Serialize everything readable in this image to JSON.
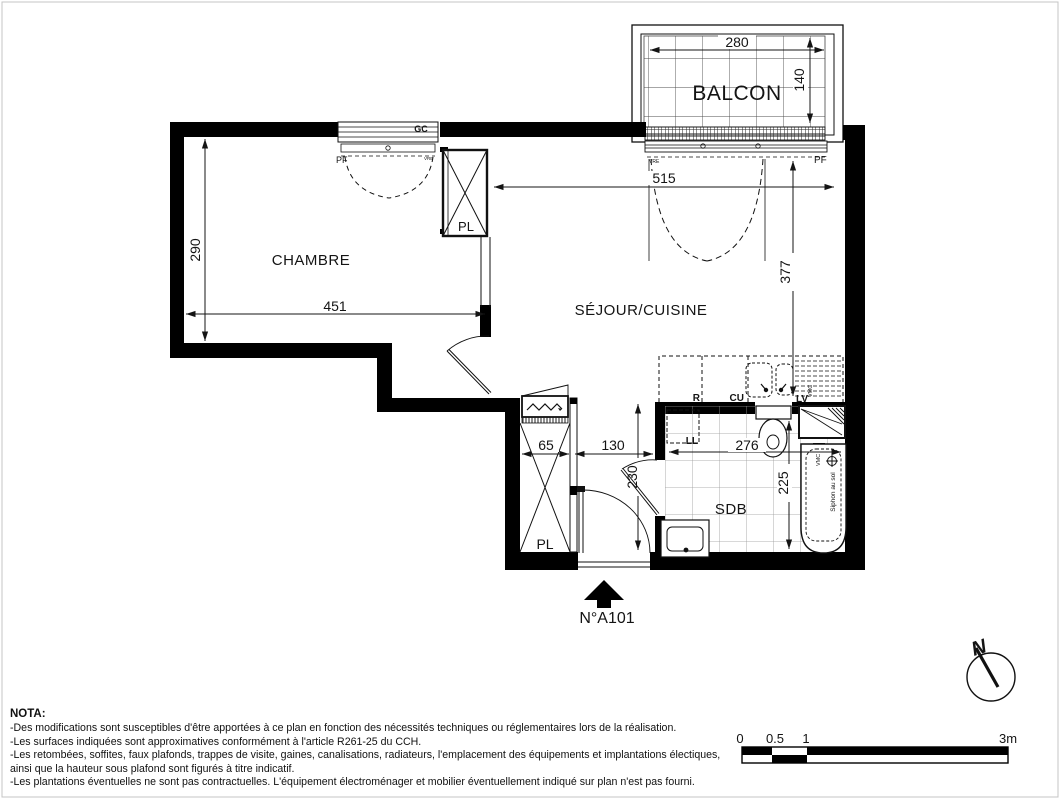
{
  "plan": {
    "unit_label": "N°A101",
    "rooms": {
      "balcon": "BALCON",
      "chambre": "CHAMBRE",
      "sejour": "SÉJOUR/CUISINE",
      "sdb": "SDB",
      "placard_top": "PL",
      "placard_entry": "PL"
    },
    "dims": {
      "balcon_width": "280",
      "balcon_depth": "140",
      "chambre_depth": "290",
      "chambre_width": "451",
      "sejour_width": "515",
      "sejour_depth": "377",
      "placard_width": "65",
      "entry_width": "130",
      "entry_depth": "230",
      "sdb_width": "276",
      "sdb_depth": "225"
    },
    "equipment": {
      "refrigerateur": "R",
      "cuisson": "CU",
      "lave_vaisselle": "LV",
      "lave_linge": "LL",
      "vmc_kitchen": "VMC",
      "vmc_bath": "VMC",
      "siphon": "Siphon au sol"
    },
    "windows": {
      "gc": "GC",
      "pf_chambre": "PF",
      "vre_chambre": "VRE",
      "vre_sejour": "VRE",
      "pf_sejour": "PF"
    },
    "compass_north": "N"
  },
  "scale_bar": {
    "tick_0": "0",
    "tick_05": "0.5",
    "tick_1": "1",
    "tick_3": "3m"
  },
  "nota": {
    "title": "NOTA:",
    "lines": [
      "-Des modifications sont susceptibles d'être apportées à ce plan en fonction des nécessités techniques ou réglementaires lors de la réalisation.",
      "-Les surfaces indiquées sont approximatives conformément à l'article R261-25 du CCH.",
      "-Les retombées, soffites, faux plafonds, trappes de visite, gaines, canalisations, radiateurs, l'emplacement des équipements et implantations électiques,",
      "ainsi que la hauteur sous plafond sont figurés à titre indicatif.",
      "-Les plantations éventuelles ne sont pas contractuelles. L'équipement électroménager et mobilier éventuellement indiqué sur plan n'est pas fourni."
    ]
  }
}
